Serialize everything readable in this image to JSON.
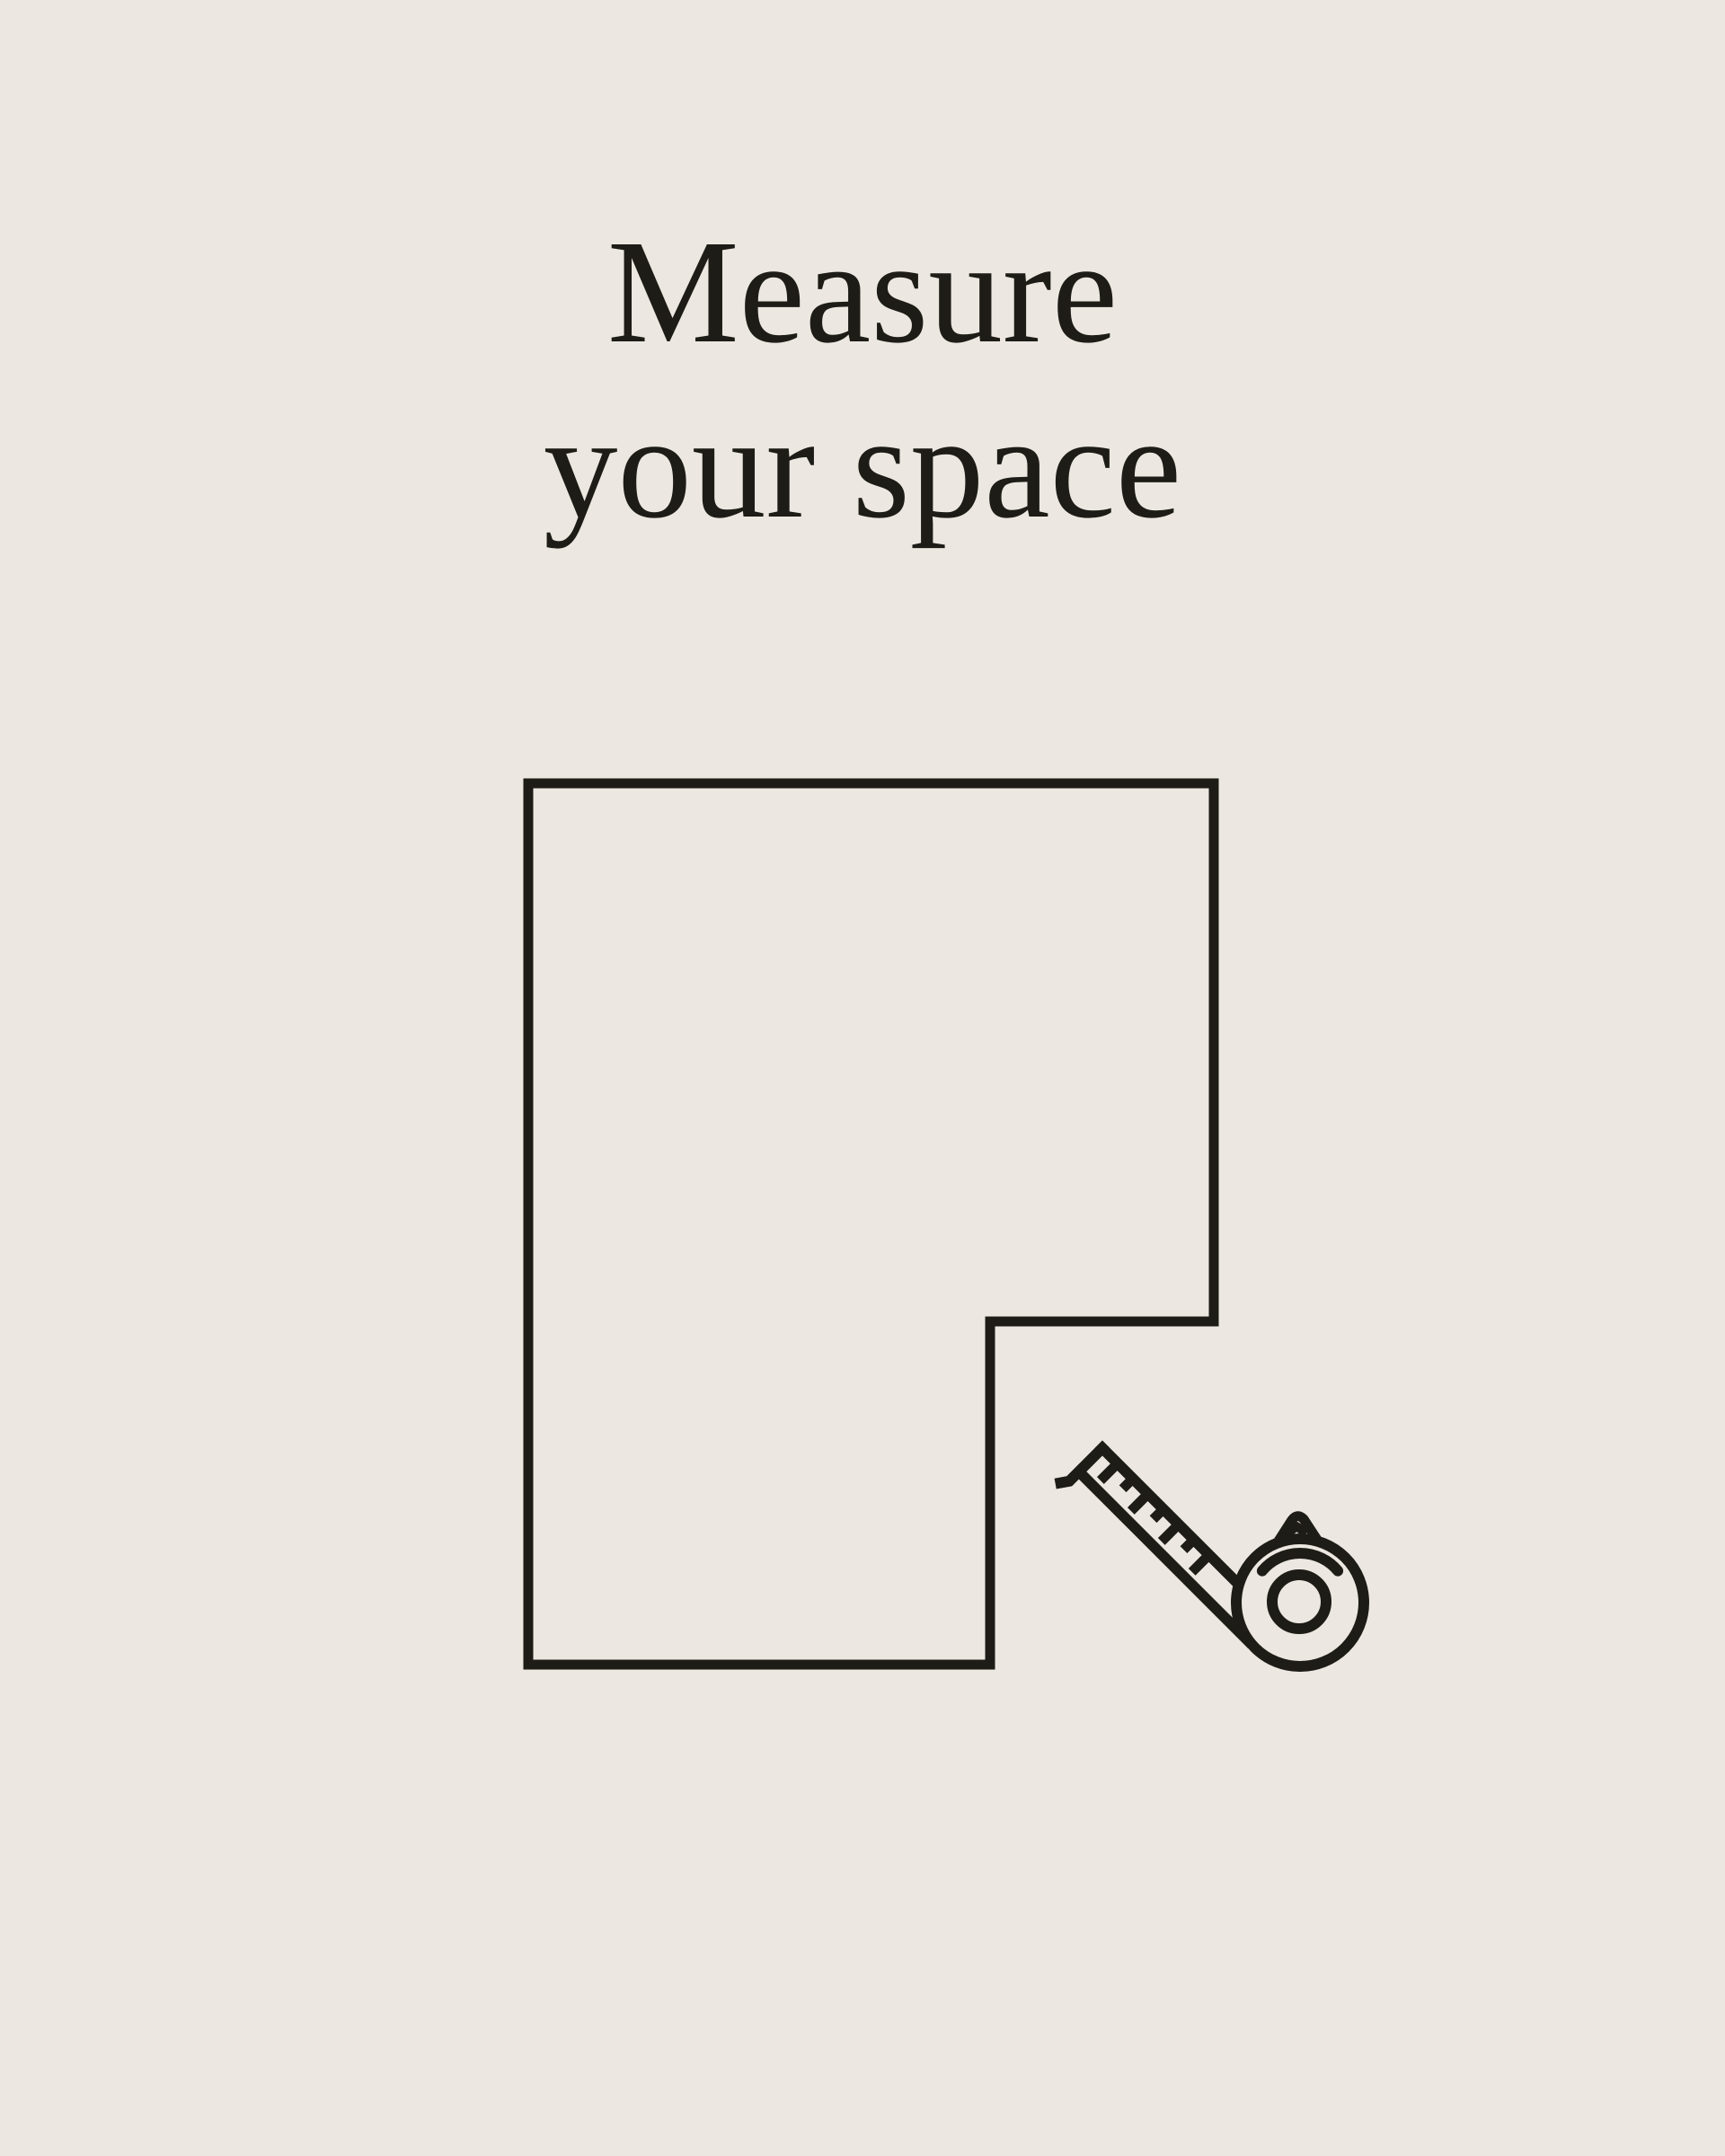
{
  "colors": {
    "background": "#ece8e1",
    "ink": "#1e1c17"
  },
  "title": {
    "line1": "Measure",
    "line2": "your space"
  },
  "illustration": {
    "description": "L-shaped room floor plan outline with tape measure icon",
    "icons": [
      "room-outline",
      "tape-measure-icon"
    ]
  }
}
